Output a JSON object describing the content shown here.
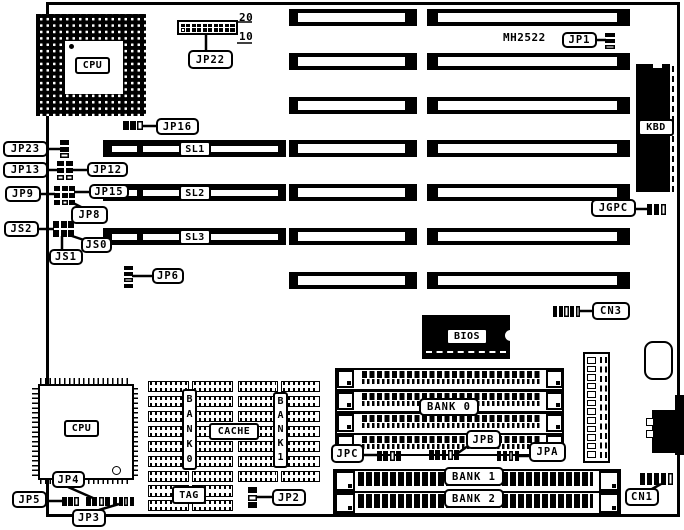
{
  "labels": {
    "jp22": "JP22",
    "jp16": "JP16",
    "jp23": "JP23",
    "jp13": "JP13",
    "jp12": "JP12",
    "jp9": "JP9",
    "jp15": "JP15",
    "jp8": "JP8",
    "js2": "JS2",
    "js0": "JS0",
    "js1": "JS1",
    "jp6": "JP6",
    "jp1": "JP1",
    "jgpc": "JGPC",
    "cn3": "CN3",
    "jp4": "JP4",
    "jp5": "JP5",
    "jp3": "JP3",
    "jp2": "JP2",
    "jpc": "JPC",
    "jpb": "JPB",
    "jpa": "JPA",
    "cn1": "CN1",
    "sl1": "SL1",
    "sl2": "SL2",
    "sl3": "SL3",
    "kbd": "KBD",
    "bios": "BIOS",
    "cpu_socket": "CPU",
    "cpu_chip": "CPU",
    "cache": "CACHE",
    "tag": "TAG",
    "bank0_vertical": "BANK0",
    "bank1_vertical": "BANK1",
    "bank0": "BANK 0",
    "bank1": "BANK 1",
    "bank2": "BANK 2",
    "chip_marking": "MH2522",
    "header_pin_top": "20",
    "header_pin_bottom": "10"
  }
}
